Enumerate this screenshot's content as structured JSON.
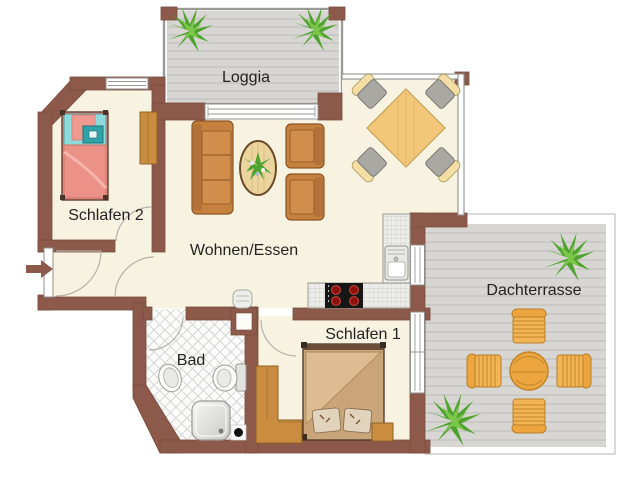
{
  "rooms": {
    "loggia": {
      "label": "Loggia"
    },
    "schlafen2": {
      "label": "Schlafen 2"
    },
    "wohnen_essen": {
      "label": "Wohnen/Essen"
    },
    "bad": {
      "label": "Bad"
    },
    "schlafen1": {
      "label": "Schlafen 1"
    },
    "dachterrasse": {
      "label": "Dachterrasse"
    }
  },
  "colors": {
    "wall": "#8c594a",
    "walledge": "#7a4b3d",
    "floor": "#f8f3e0",
    "deck": "#d7d6d3",
    "deckline": "#bdbcb9",
    "wood": "#ca8c3e",
    "sofa": "#c6813f",
    "bed2blanket": "#ec9187",
    "bed2head": "#8edbdc",
    "bed1blanket": "#cba57a",
    "diningtable": "#f2c878",
    "terracefurn": "#eda63f",
    "plant": "#4ea32e",
    "tileline": "#ccd3d8",
    "cooktop": "#161616",
    "burner": "#8c1010",
    "labeltext": "#222222"
  }
}
